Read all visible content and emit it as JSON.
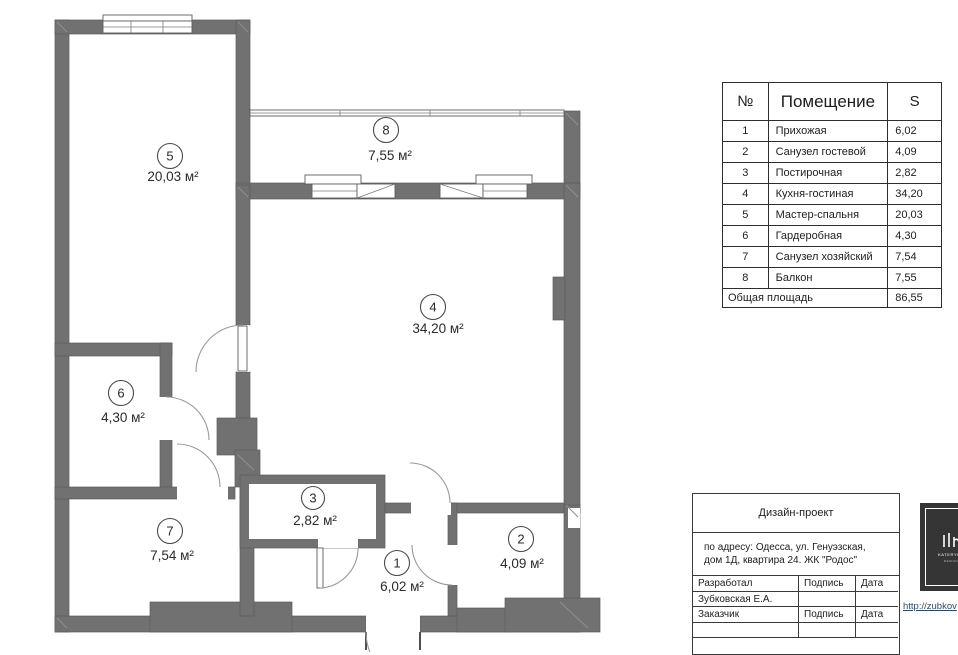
{
  "plan": {
    "wall_color": "#717171",
    "rooms": [
      {
        "number": "1",
        "area": "6,02 м²"
      },
      {
        "number": "2",
        "area": "4,09 м²"
      },
      {
        "number": "3",
        "area": "2,82 м²"
      },
      {
        "number": "4",
        "area": "34,20 м²"
      },
      {
        "number": "5",
        "area": "20,03 м²"
      },
      {
        "number": "6",
        "area": "4,30 м²"
      },
      {
        "number": "7",
        "area": "7,54 м²"
      },
      {
        "number": "8",
        "area": "7,55 м²"
      }
    ]
  },
  "schedule_table": {
    "headers": {
      "num": "№",
      "room": "Помещение",
      "area": "S"
    },
    "rows": [
      {
        "num": "1",
        "room": "Прихожая",
        "area": "6,02"
      },
      {
        "num": "2",
        "room": "Санузел гостевой",
        "area": "4,09"
      },
      {
        "num": "3",
        "room": "Постирочная",
        "area": "2,82"
      },
      {
        "num": "4",
        "room": "Кухня-гостиная",
        "area": "34,20"
      },
      {
        "num": "5",
        "room": "Мастер-спальня",
        "area": "20,03"
      },
      {
        "num": "6",
        "room": "Гардеробная",
        "area": "4,30"
      },
      {
        "num": "7",
        "room": "Санузел хозяйский",
        "area": "7,54"
      },
      {
        "num": "8",
        "room": "Балкон",
        "area": "7,55"
      }
    ],
    "total_label": "Общая площадь",
    "total_value": "86,55"
  },
  "title_block": {
    "project_type": "Дизайн-проект",
    "address_line1": "по адресу: Одесса, ул. Генуэзская,",
    "address_line2": "дом 1Д, квартира 24. ЖК \"Родос\"",
    "developed_label": "Разработал",
    "developer_name": "Зубковская Е.А.",
    "client_label": "Заказчик",
    "signature_label": "Подпись",
    "date_label": "Дата"
  },
  "branding": {
    "logo_caption": "KATERYNA",
    "logo_subcaption": "DESIGN",
    "website": "http://zubkov"
  }
}
